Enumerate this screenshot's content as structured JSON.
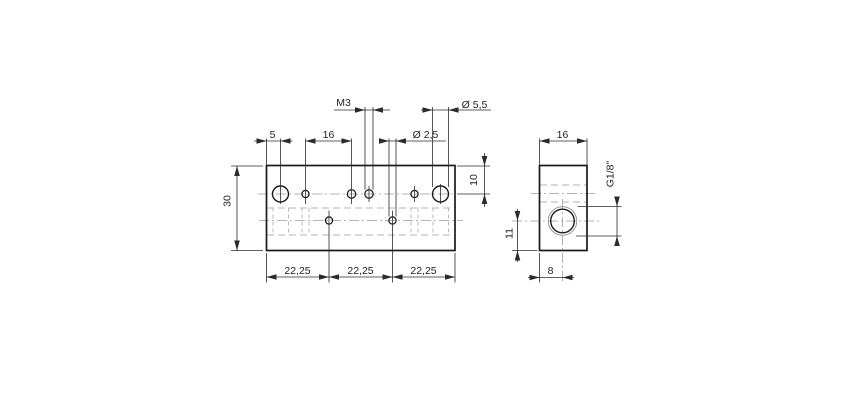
{
  "colors": {
    "outline": "#1a1a1a",
    "dimension": "#2b2b2b",
    "hidden_line": "#b3b3b3",
    "centerline": "#9a9a9a",
    "background": "#ffffff"
  },
  "front_view": {
    "dim_left_offset": "5",
    "dim_hole_spacing": "16",
    "thread_callout": "M3",
    "dia_small": "Ø 2,5",
    "dia_large": "Ø 5,5",
    "dim_height": "30",
    "dim_top_offset": "10",
    "bottom_segments": [
      "22,25",
      "22,25",
      "22,25"
    ]
  },
  "side_view": {
    "dim_width": "16",
    "port_thread": "G1/8\"",
    "dim_center_from_bottom": "11",
    "dim_center_from_left": "8"
  }
}
